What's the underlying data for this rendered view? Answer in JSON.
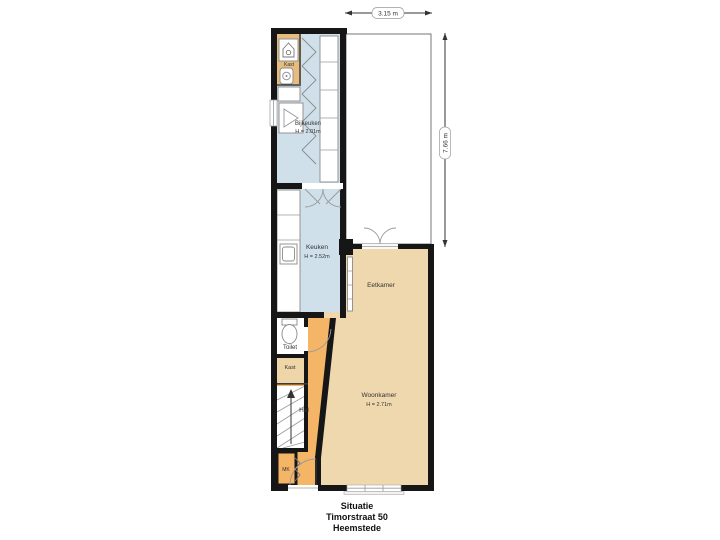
{
  "caption": {
    "line1": "Situatie",
    "line2": "Timorstraat 50",
    "line3": "Heemstede"
  },
  "dimensions": {
    "width_label": "3.15 m",
    "height_label": "7.66 m"
  },
  "rooms": {
    "kast_top": {
      "label": "Kast"
    },
    "bijkeuken": {
      "label": "Bijkeuken",
      "height": "H = 2.01m"
    },
    "keuken": {
      "label": "Keuken",
      "height": "H = 2.52m"
    },
    "eetkamer": {
      "label": "Eetkamer"
    },
    "woonkamer": {
      "label": "Woonkamer",
      "height": "H = 2.71m"
    },
    "toilet": {
      "label": "Toilet"
    },
    "kast_hal": {
      "label": "Kast"
    },
    "hal": {
      "label": "Hal"
    },
    "mk": {
      "label": "MK"
    }
  },
  "colors": {
    "wall": "#161616",
    "kitchen_floor": "#cfe0ea",
    "living_floor": "#f0d8ae",
    "hall_floor": "#f4b566",
    "closet_top_floor": "#e7bd7e",
    "closet_hal_floor": "#eed6a9",
    "terrace_tile": "#d6d6d6",
    "terrace_grout": "#c7c7c7",
    "fixture_outline": "#8a8a8a",
    "label_text": "#333333",
    "caption_text": "#111111"
  }
}
